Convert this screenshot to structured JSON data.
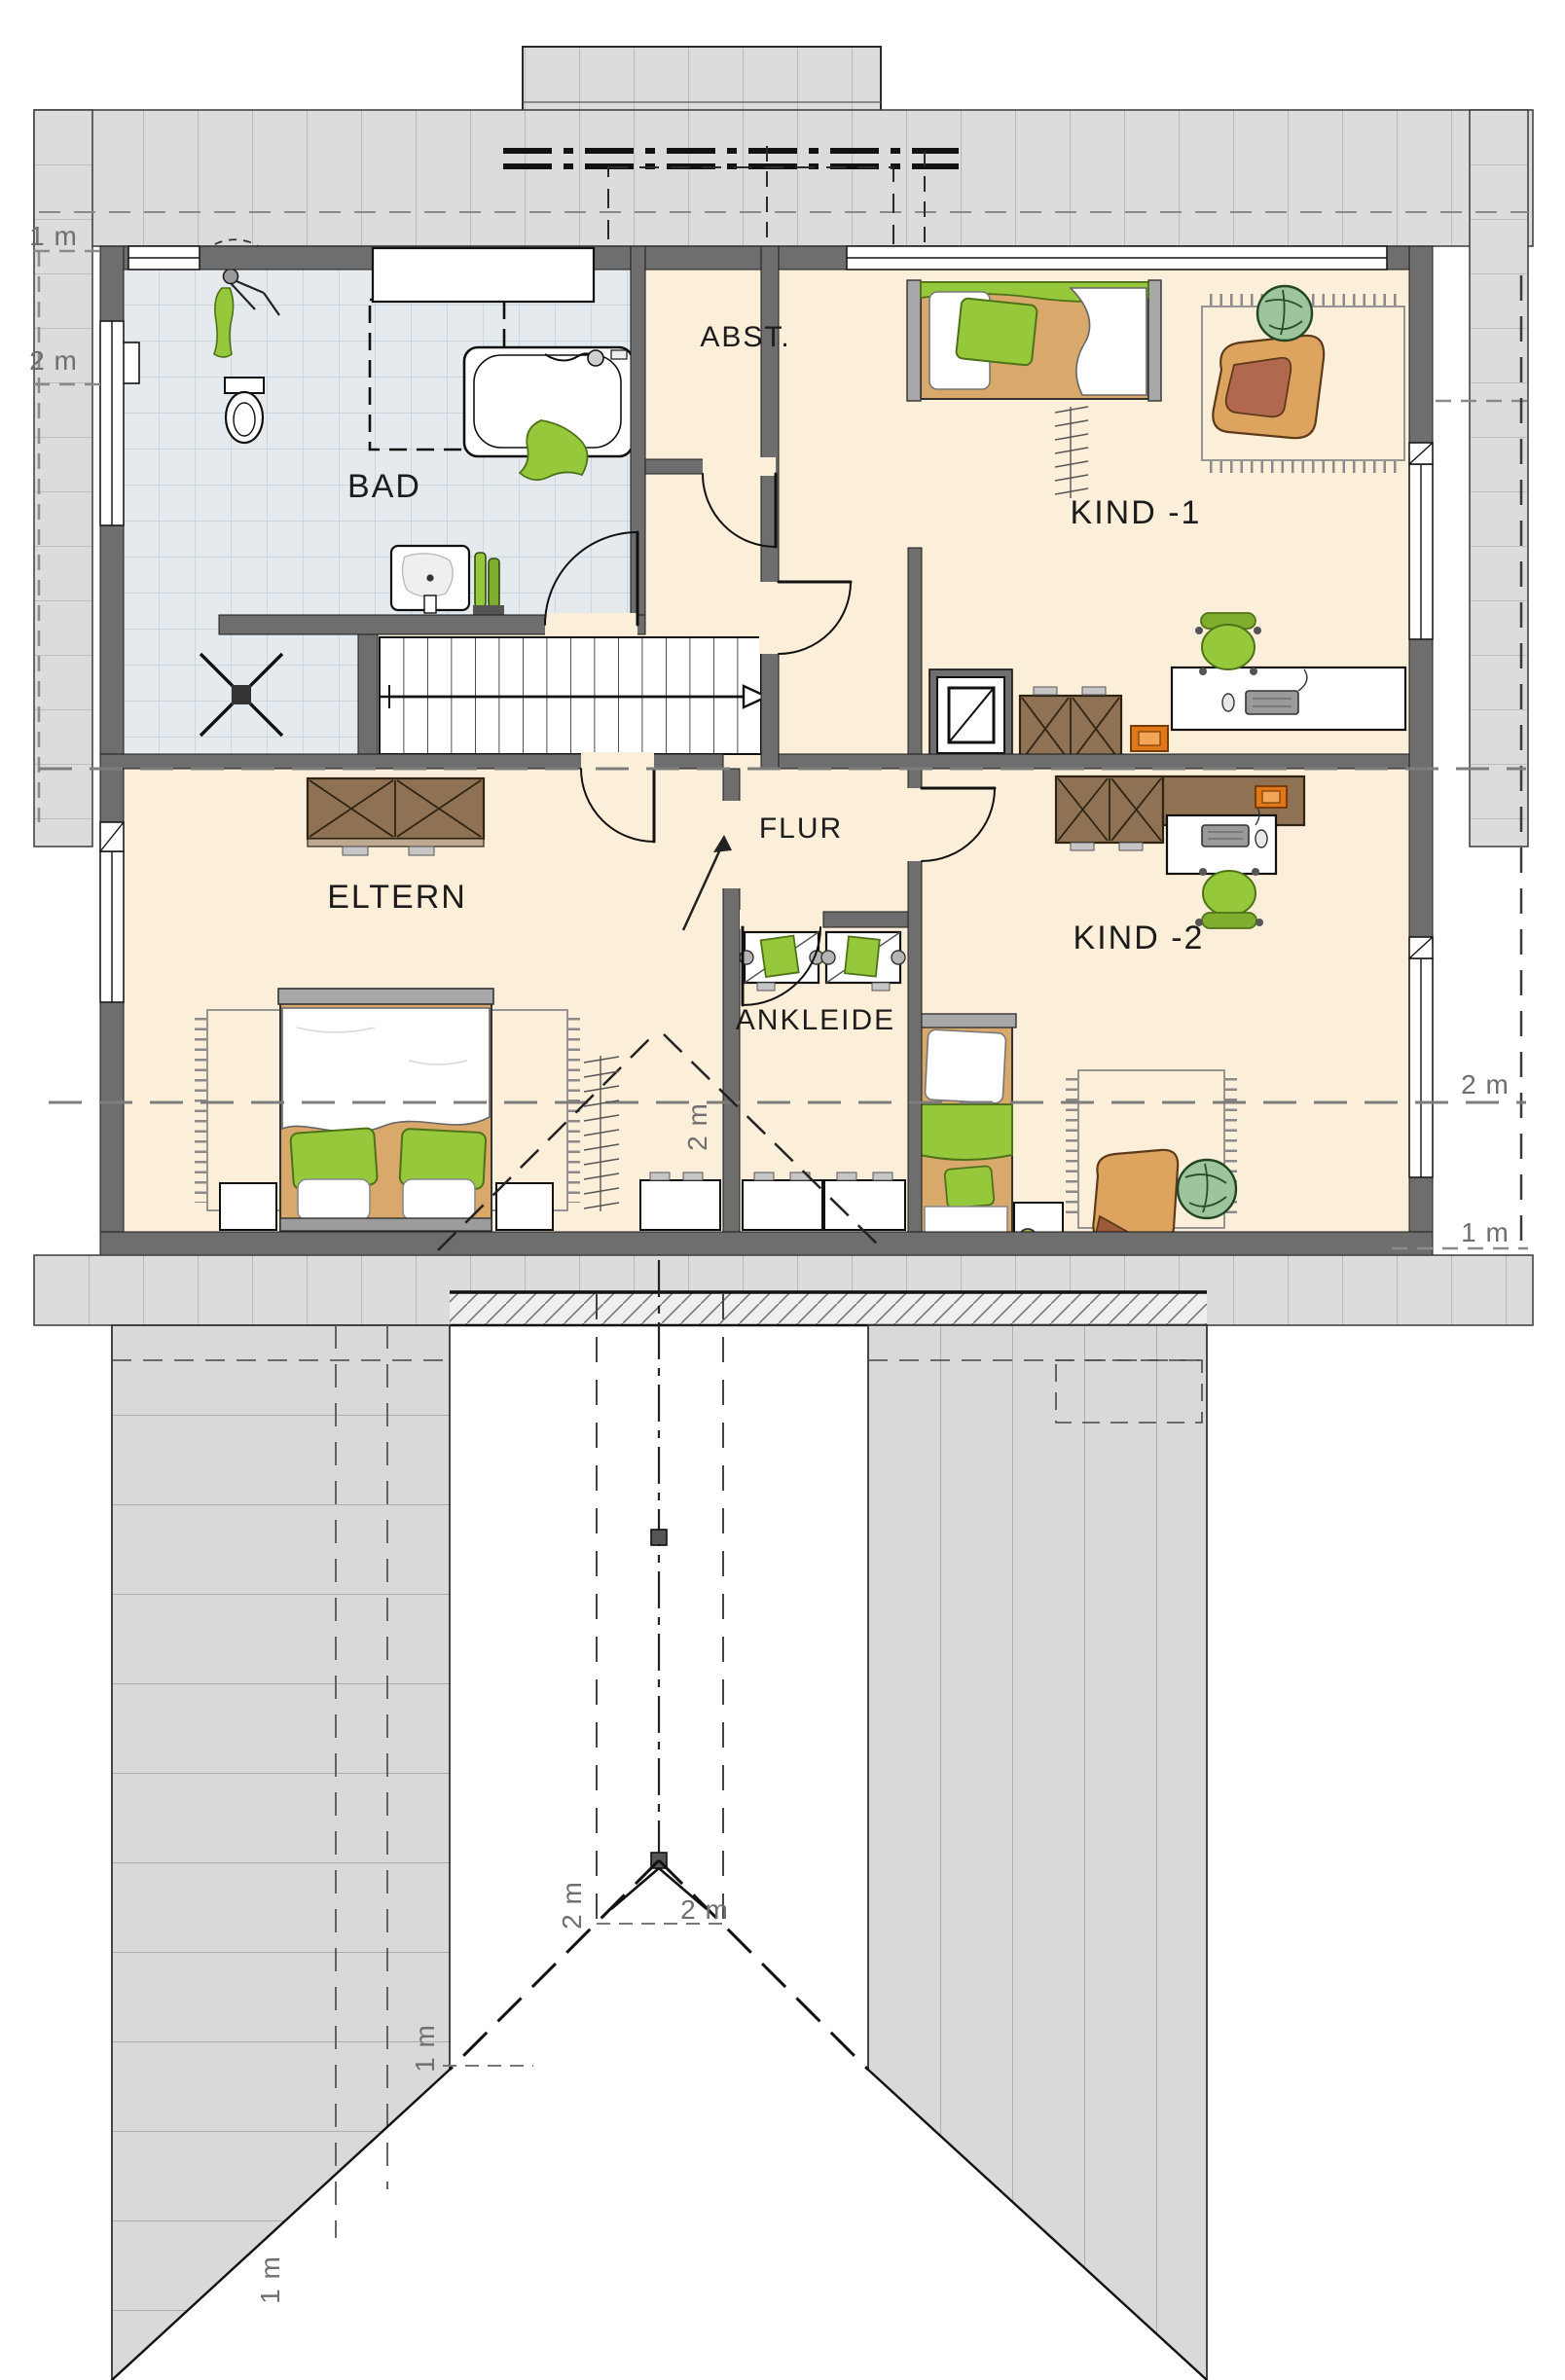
{
  "rooms": {
    "bad": "BAD",
    "abst": "ABST.",
    "kind1": "KIND -1",
    "flur": "FLUR",
    "eltern": "ELTERN",
    "ankleide": "ANKLEIDE",
    "kind2": "KIND -2"
  },
  "dimensions": {
    "left_1m": "1 m",
    "left_2m": "2 m",
    "ankleide_2m": "2 m",
    "right_2m": "2 m",
    "right_1m": "1 m",
    "gable_2m_left": "2 m",
    "gable_2m_right": "2 m",
    "gable_1m": "1 m",
    "hip_1m": "1 m"
  },
  "colors": {
    "floor_cream": "#fcefd9",
    "tile_blue": "#e4eaee",
    "wall_gray": "#6e6e6e",
    "roof_gray": "#dcdcdc",
    "accent_green": "#96c83c",
    "accent_orange": "#e07818",
    "furniture_brown": "#8f7253",
    "bed_tan": "#d9a96b"
  }
}
